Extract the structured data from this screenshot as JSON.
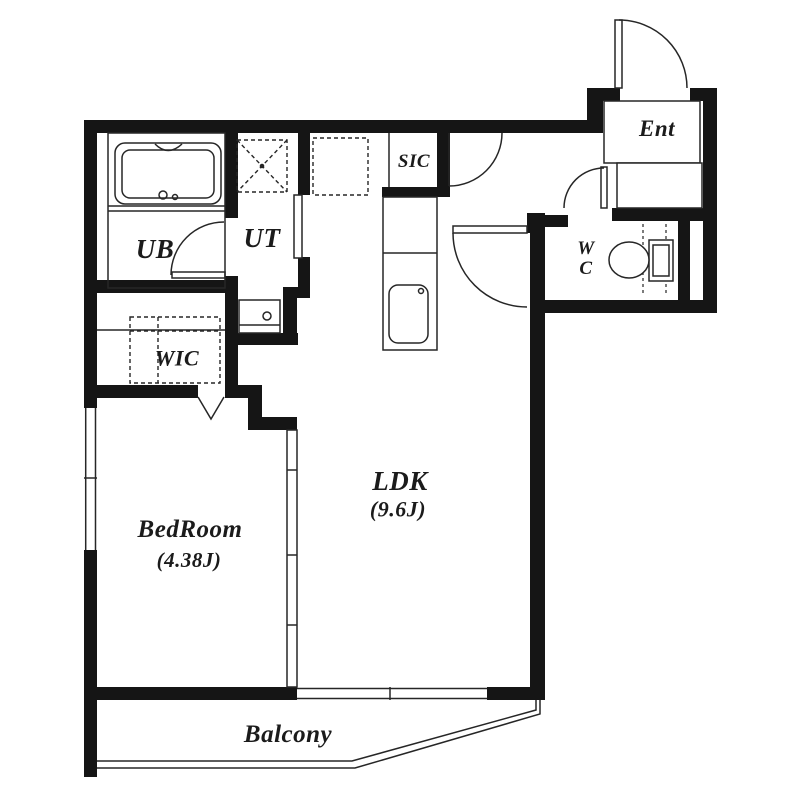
{
  "plan": {
    "rooms": {
      "ub": {
        "label": "UB"
      },
      "ut": {
        "label": "UT"
      },
      "sic": {
        "label": "SIC"
      },
      "ent": {
        "label": "Ent"
      },
      "wc": {
        "line1": "W",
        "line2": "C"
      },
      "wic": {
        "label": "WIC"
      },
      "bedroom": {
        "label": "BedRoom",
        "area": "(4.38J)"
      },
      "ldk": {
        "label": "LDK",
        "area": "(9.6J)"
      },
      "balcony": {
        "label": "Balcony"
      }
    },
    "fixtures": [
      "bathtub",
      "washing-machine-pan",
      "refrigerator-space",
      "kitchen-counter",
      "kitchen-sink",
      "washbasin",
      "toilet",
      "closet-hanger",
      "entry-step",
      "sliding-partition"
    ],
    "colors": {
      "wall": "#151515",
      "line": "#262626",
      "background": "#ffffff"
    }
  }
}
